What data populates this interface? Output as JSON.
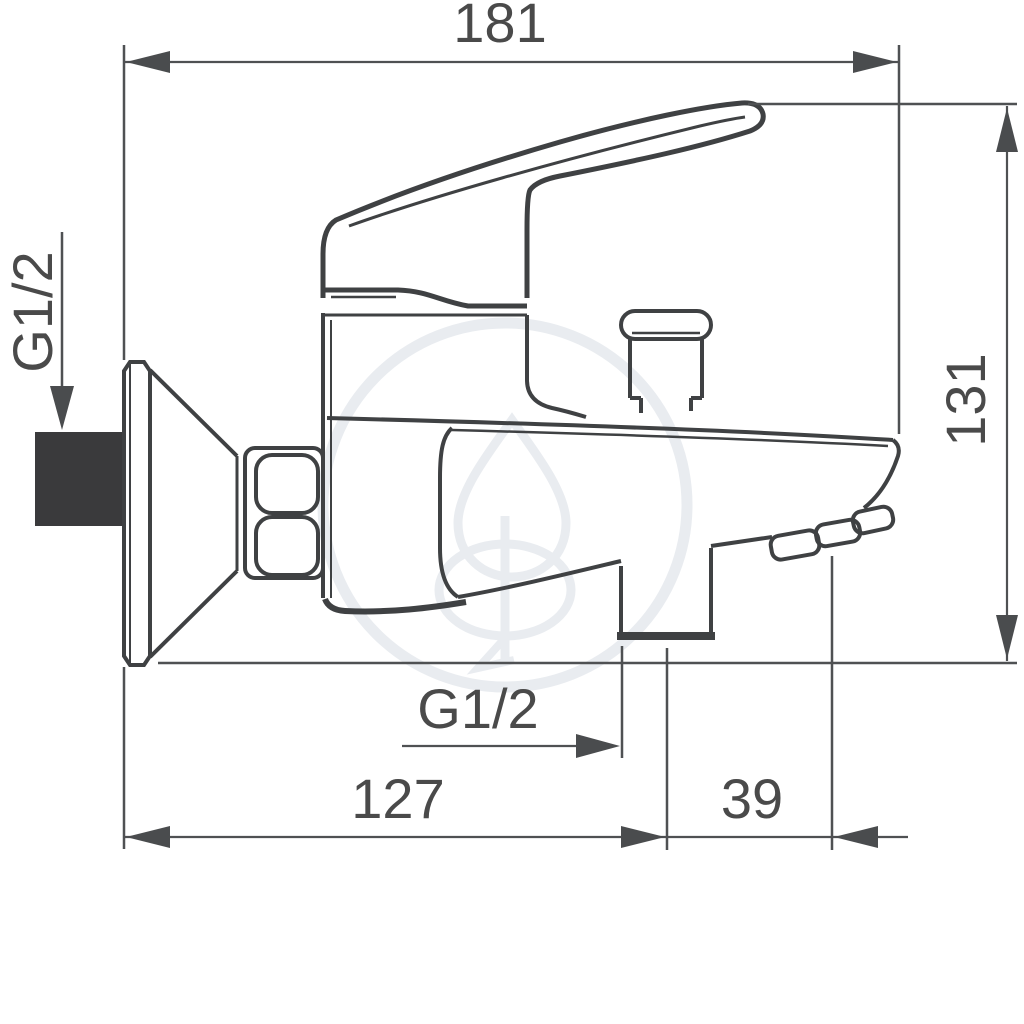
{
  "drawing": {
    "type": "technical-dimension-drawing",
    "subject": "wall-mounted single-lever bath shower mixer, side view",
    "colors": {
      "background": "#ffffff",
      "outline": "#3f4143",
      "dimension_lines": "#4f5153",
      "text": "#4a4a4a",
      "inlet_fill": "#3a3a3c",
      "watermark": "#e9ecf0"
    },
    "dimensions": {
      "total_width": "181",
      "total_height": "131",
      "inlet_thread": "G1/2",
      "outlet_thread": "G1/2",
      "wall_to_outlet_center": "127",
      "outlet_center_to_spout_tip": "39"
    }
  }
}
